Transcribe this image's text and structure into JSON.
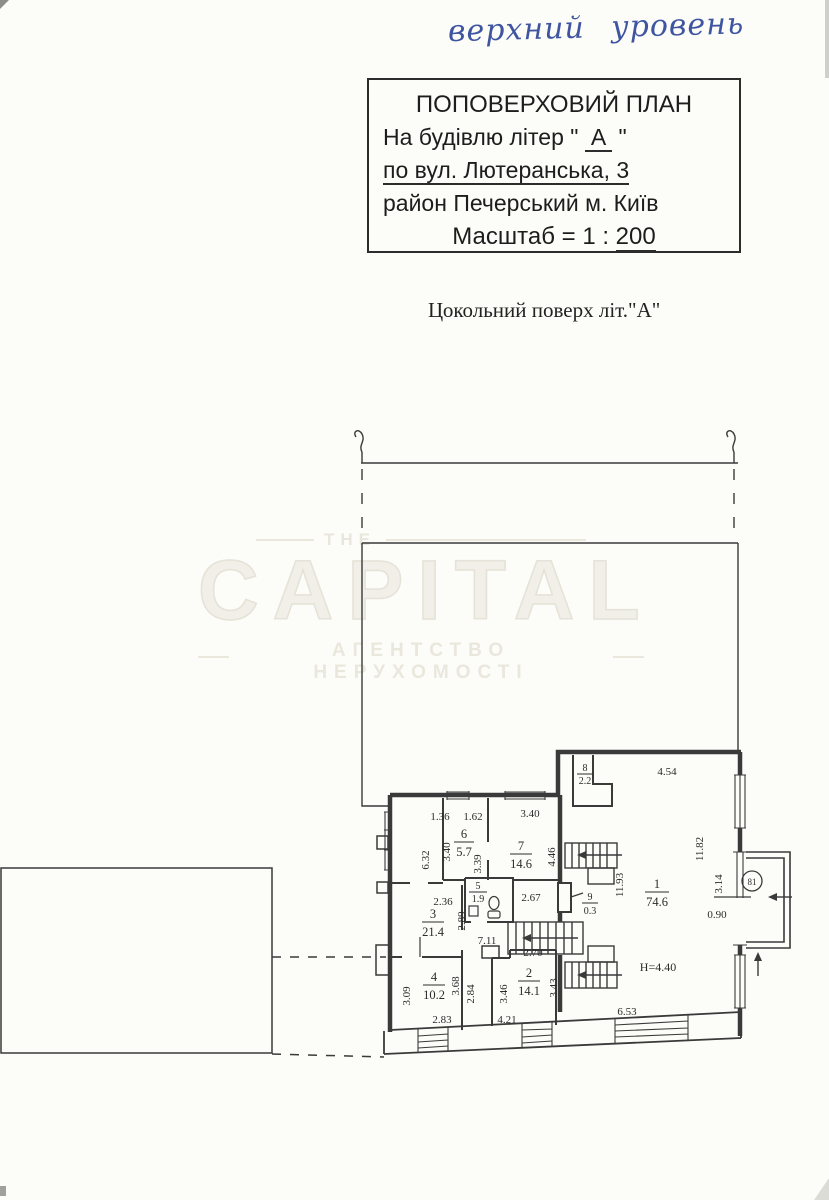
{
  "handwriting": "верхний уровень",
  "title_block": {
    "line1": "ПОПОВЕРХОВИЙ ПЛАН",
    "line2_prefix": "На будівлю літер \" ",
    "line2_letter": "А",
    "line2_suffix": " \"",
    "line3": "по вул. Лютеранська, 3",
    "line4": "район  Печерський  м. Київ",
    "line5_prefix": "Масштаб = 1 : ",
    "line5_scale": "200"
  },
  "subtitle": "Цокольний поверх  літ.\"А\"",
  "watermark": {
    "small": "ТНЕ",
    "brand": "CAPITAL",
    "tagline": "АГЕНТСТВО НЕРУХОМОСТІ"
  },
  "plan": {
    "rooms": [
      {
        "num": "1",
        "area": "74.6"
      },
      {
        "num": "2",
        "area": "14.1"
      },
      {
        "num": "3",
        "area": "21.4"
      },
      {
        "num": "4",
        "area": "10.2"
      },
      {
        "num": "5",
        "area": "1.9"
      },
      {
        "num": "6",
        "area": "5.7"
      },
      {
        "num": "7",
        "area": "14.6"
      },
      {
        "num": "8",
        "area": "2.2"
      },
      {
        "num": "9",
        "area": "0.3"
      }
    ],
    "dims": [
      "1.36",
      "1.62",
      "3.40",
      "3.40",
      "6.32",
      "3.39",
      "4.46",
      "2.36",
      "2.67",
      "2.89",
      "7.11",
      "2.70",
      "3.09",
      "3.68",
      "2.84",
      "3.46",
      "3.43",
      "2.83",
      "4.21",
      "6.53",
      "4.54",
      "11.82",
      "11.93",
      "3.14",
      "0.90"
    ],
    "height_note": "Н=4.40",
    "badge": "81",
    "line_color": "#3a3a3a"
  }
}
